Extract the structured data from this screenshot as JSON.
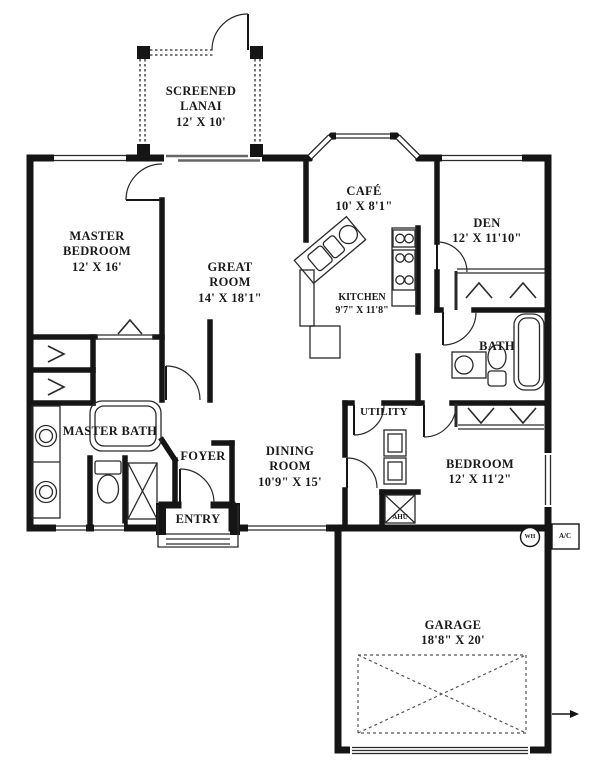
{
  "page": {
    "type": "architectural-floor-plan",
    "colors": {
      "walls": "#151515",
      "paper": "#ffffff",
      "thin_line": "#2a2a2a"
    }
  },
  "rooms": {
    "screened_lanai": {
      "lines": [
        "SCREENED",
        "LANAI",
        "12' X 10'"
      ]
    },
    "cafe": {
      "lines": [
        "CAFÉ",
        "10' X 8'1\""
      ]
    },
    "den": {
      "lines": [
        "DEN",
        "12' X 11'10\""
      ]
    },
    "master_bedroom": {
      "lines": [
        "MASTER",
        "BEDROOM",
        "12' X 16'"
      ]
    },
    "great_room": {
      "lines": [
        "GREAT",
        "ROOM",
        "14' X 18'1\""
      ]
    },
    "kitchen": {
      "lines": [
        "KITCHEN",
        "9'7\" X 11'8\""
      ]
    },
    "bath": {
      "lines": [
        "BATH"
      ]
    },
    "master_bath": {
      "lines": [
        "MASTER BATH"
      ]
    },
    "foyer": {
      "lines": [
        "FOYER"
      ]
    },
    "entry": {
      "lines": [
        "ENTRY"
      ]
    },
    "dining_room": {
      "lines": [
        "DINING",
        "ROOM",
        "10'9\" X 15'"
      ]
    },
    "utility": {
      "lines": [
        "UTILITY"
      ]
    },
    "bedroom": {
      "lines": [
        "BEDROOM",
        "12' X 11'2\""
      ]
    },
    "garage": {
      "lines": [
        "GARAGE",
        "18'8\" X 20'"
      ]
    }
  },
  "equipment": {
    "water_heater": "WH",
    "air_conditioner": "A/C",
    "air_handler": "AHU"
  }
}
